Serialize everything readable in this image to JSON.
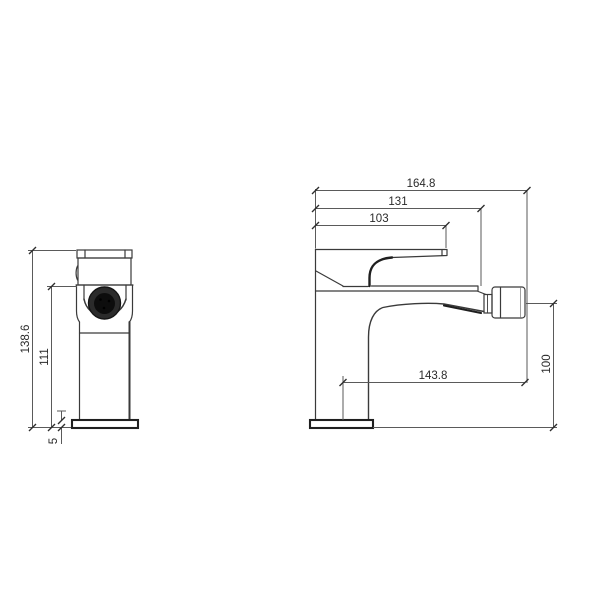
{
  "drawing": {
    "type": "technical-cad-drawing",
    "subject": "bidet-basin-mixer-faucet",
    "background": "#ffffff",
    "line_color": "#3a3a3a",
    "dimension_color": "#5a5a5a",
    "front_view": {
      "dimensions": {
        "total_height": {
          "label": "138.6"
        },
        "body_height": {
          "label": "111"
        },
        "base_thickness": {
          "label": "5"
        }
      }
    },
    "side_view": {
      "dimensions": {
        "total_depth": {
          "label": "164.8"
        },
        "body_depth": {
          "label": "131"
        },
        "handle_depth": {
          "label": "103"
        },
        "spout_reach": {
          "label": "143.8"
        },
        "spout_height": {
          "label": "100"
        }
      }
    }
  }
}
